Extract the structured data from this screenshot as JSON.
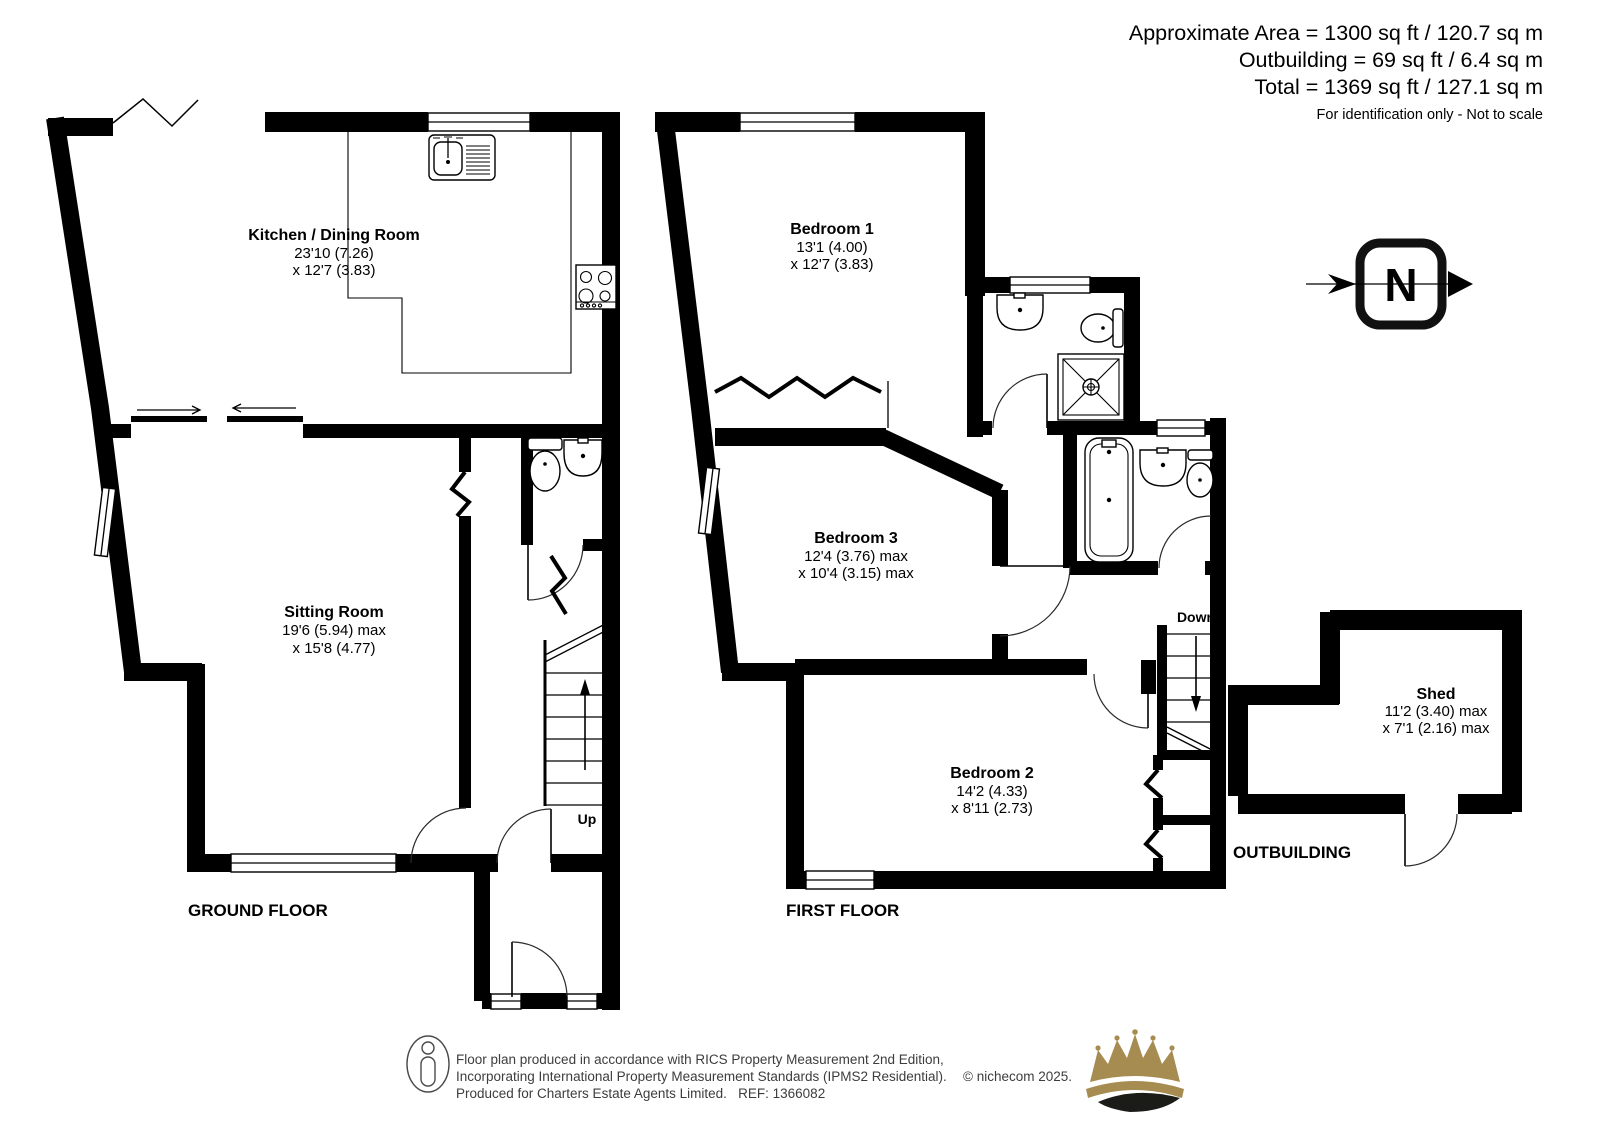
{
  "header": {
    "area_line": "Approximate Area = 1300 sq ft / 120.7 sq m",
    "outbuilding_line": "Outbuilding = 69 sq ft / 6.4 sq m",
    "total_line": "Total = 1369 sq ft / 127.1 sq m",
    "note": "For identification only - Not to scale"
  },
  "ground_floor": {
    "label": "GROUND FLOOR",
    "stairs_label": "Up",
    "rooms": {
      "kitchen": {
        "name": "Kitchen / Dining Room",
        "dim1": "23'10 (7.26)",
        "dim2": "x 12'7 (3.83)"
      },
      "sitting": {
        "name": "Sitting Room",
        "dim1": "19'6 (5.94) max",
        "dim2": "x 15'8 (4.77)"
      }
    }
  },
  "first_floor": {
    "label": "FIRST FLOOR",
    "stairs_label": "Down",
    "rooms": {
      "bedroom1": {
        "name": "Bedroom 1",
        "dim1": "13'1 (4.00)",
        "dim2": "x 12'7 (3.83)"
      },
      "bedroom3": {
        "name": "Bedroom 3",
        "dim1": "12'4 (3.76) max",
        "dim2": "x 10'4 (3.15) max"
      },
      "bedroom2": {
        "name": "Bedroom 2",
        "dim1": "14'2 (4.33)",
        "dim2": "x 8'11 (2.73)"
      }
    }
  },
  "outbuilding": {
    "label": "OUTBUILDING",
    "rooms": {
      "shed": {
        "name": "Shed",
        "dim1": "11'2 (3.40) max",
        "dim2": "x 7'1 (2.16) max"
      }
    }
  },
  "compass": {
    "label": "N"
  },
  "footer": {
    "line1": "Floor plan produced in accordance with RICS Property Measurement 2nd Edition,",
    "line2": "Incorporating International Property Measurement Standards (IPMS2 Residential).",
    "line3": "Produced for Charters Estate Agents Limited.   REF: 1366082",
    "copyright": "© nichecom 2025."
  },
  "colors": {
    "wall": "#000000",
    "footer_text": "#3d3d3d",
    "crown_gold": "#A78C52",
    "crown_dark": "#1B1B18"
  }
}
